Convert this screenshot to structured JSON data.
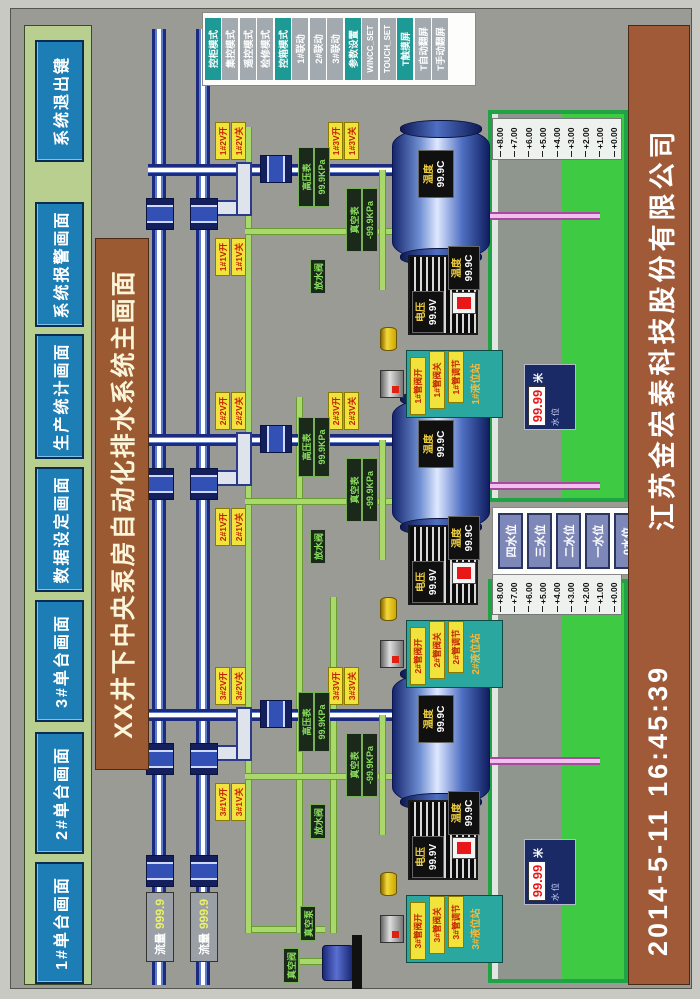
{
  "title": "XX井下中央泵房自动化排水系统主画面",
  "top_nav": {
    "buttons": [
      "1#单台画面",
      "2#单台画面",
      "3#单台画面",
      "数据设定画面",
      "生产统计画面",
      "系统报警画面",
      "系统退出键"
    ]
  },
  "mode_buttons": [
    {
      "label": "控柜模式",
      "active": true
    },
    {
      "label": "集控模式",
      "active": false
    },
    {
      "label": "遥控模式",
      "active": false
    },
    {
      "label": "检修模式",
      "active": false
    },
    {
      "label": "控箱模式",
      "active": true
    },
    {
      "label": "1#联动",
      "active": false
    },
    {
      "label": "2#联动",
      "active": false
    },
    {
      "label": "3#联动",
      "active": false
    },
    {
      "label": "参数设置",
      "active": true
    },
    {
      "label": "WINCC_SET",
      "active": false
    },
    {
      "label": "TOUCH_SET",
      "active": false
    },
    {
      "label": "T触摸屏",
      "active": true
    },
    {
      "label": "T自动翻屏",
      "active": false
    },
    {
      "label": "T手动翻屏",
      "active": false
    }
  ],
  "manifolds": {
    "flow_upper": {
      "label": "流量",
      "value": "999.9"
    },
    "flow_lower": {
      "label": "流量",
      "value": "999.9"
    }
  },
  "pumps": [
    {
      "box": {
        "rows": [
          "3#管阀开",
          "3#管阀关",
          "3#管调节"
        ],
        "title": "3#液位站"
      },
      "pairs": {
        "a": [
          "3#1V开",
          "3#1V关"
        ],
        "b": [
          "3#2V开",
          "3#2V关"
        ],
        "c": [
          "3#3V开",
          "3#3V关"
        ]
      },
      "gauges": {
        "p_label": "高压表",
        "p_value": "99.9KPa",
        "v_label": "真空表",
        "v_value": "-99.9KPa",
        "drain": "放水阀"
      },
      "motor": {
        "v_label": "电压",
        "v_value": "99.9V",
        "t_label": "温度",
        "t_value": "99.9C"
      },
      "barrel": {
        "t_label": "温度",
        "t_value": "99.9C"
      }
    },
    {
      "box": {
        "rows": [
          "2#管阀开",
          "2#管阀关",
          "2#管调节"
        ],
        "title": "2#液位站"
      },
      "pairs": {
        "a": [
          "2#1V开",
          "2#1V关"
        ],
        "b": [
          "2#2V开",
          "2#2V关"
        ],
        "c": [
          "2#3V开",
          "2#3V关"
        ]
      },
      "gauges": {
        "p_label": "高压表",
        "p_value": "99.9KPa",
        "v_label": "真空表",
        "v_value": "-99.9KPa",
        "drain": "放水阀"
      },
      "motor": {
        "v_label": "电压",
        "v_value": "99.9V",
        "t_label": "温度",
        "t_value": "99.9C"
      },
      "barrel": {
        "t_label": "温度",
        "t_value": "99.9C"
      }
    },
    {
      "box": {
        "rows": [
          "1#管阀开",
          "1#管阀关",
          "1#管调节"
        ],
        "title": "1#液位站"
      },
      "pairs": {
        "a": [
          "1#1V开",
          "1#1V关"
        ],
        "b": [
          "1#2V开",
          "1#2V关"
        ],
        "c": [
          "1#3V开",
          "1#3V关"
        ]
      },
      "gauges": {
        "p_label": "高压表",
        "p_value": "99.9KPa",
        "v_label": "真空表",
        "v_value": "-99.9KPa",
        "drain": "放水阀"
      },
      "motor": {
        "v_label": "电压",
        "v_value": "99.9V",
        "t_label": "温度",
        "t_value": "99.9C"
      },
      "barrel": {
        "t_label": "温度",
        "t_value": "99.9C"
      }
    }
  ],
  "sumps": {
    "scale_labels": [
      "+8.00",
      "+7.00",
      "+6.00",
      "+5.00",
      "+4.00",
      "+3.00",
      "+2.00",
      "+1.00",
      "+0.00"
    ],
    "left_level": {
      "label": "水位",
      "value": "99.99",
      "unit": "米"
    },
    "right_level": {
      "label": "水位",
      "value": "99.99",
      "unit": "米"
    }
  },
  "level_buttons": [
    "四水位",
    "三水位",
    "二水位",
    "一水位",
    "0水位"
  ],
  "vacuum": {
    "valve_label": "真空阀",
    "pump_label": "真空泵"
  },
  "footer": {
    "datetime": "2014-5-11  16:45:39",
    "company": "江苏金宏泰科技股份有限公司"
  }
}
